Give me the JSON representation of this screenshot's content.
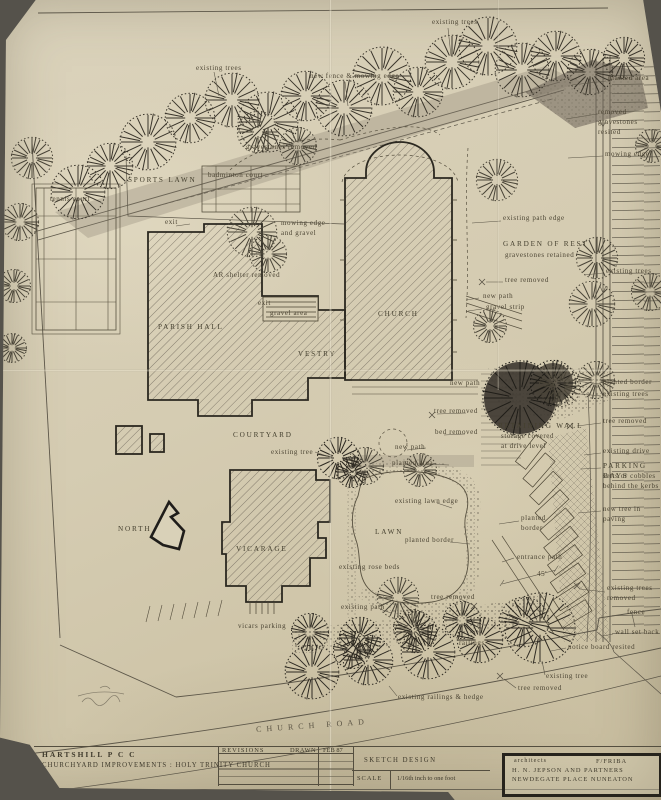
{
  "title_block": {
    "client": "HARTSHILL  P C C",
    "project": "CHURCHYARD IMPROVEMENTS : HOLY TRINITY CHURCH",
    "revisions_label": "REVISIONS",
    "drawn_label": "DRAWN",
    "drawn_date": "FEB 87",
    "stage": "SKETCH DESIGN",
    "scale_label": "SCALE",
    "scale_value": "1/16th inch to one foot"
  },
  "architects": {
    "label": "architects",
    "qualification": "F/FRIBA",
    "name": "H. N. JEPSON AND PARTNERS",
    "address": "NEWDEGATE PLACE NUNEATON"
  },
  "colors": {
    "paper": "#d5ccb2",
    "ink": "#4b4433",
    "building_outline": "#2b2820",
    "shading": "#6e675a"
  },
  "labels": [
    {
      "text": "existing trees",
      "x": 196,
      "y": 64,
      "cls": "tiny",
      "name": "label-existing-trees-top-left"
    },
    {
      "text": "new fence & mowing edge",
      "x": 310,
      "y": 72,
      "cls": "tiny",
      "name": "label-new-fence-mowing-edge"
    },
    {
      "text": "existing trees",
      "x": 432,
      "y": 18,
      "cls": "tiny",
      "name": "label-existing-trees-top"
    },
    {
      "text": "planted area",
      "x": 608,
      "y": 74,
      "cls": "tiny",
      "name": "label-planted-area-right"
    },
    {
      "text": "removed\ngravestones resited",
      "x": 598,
      "y": 108,
      "cls": "tiny",
      "name": "label-removed-gravestones-resited"
    },
    {
      "text": "mowing edge",
      "x": 605,
      "y": 150,
      "cls": "tiny",
      "name": "label-mowing-edge-right"
    },
    {
      "text": "existing trees",
      "x": 606,
      "y": 267,
      "cls": "tiny",
      "name": "label-existing-trees-right"
    },
    {
      "text": "gravestones removed",
      "x": 246,
      "y": 143,
      "cls": "tiny",
      "name": "label-gravestones-removed"
    },
    {
      "text": "SPORTS LAWN",
      "x": 128,
      "y": 175,
      "cls": "caps",
      "name": "label-sports-lawn"
    },
    {
      "text": "tennis court",
      "x": 50,
      "y": 195,
      "cls": "tiny",
      "name": "label-tennis-court"
    },
    {
      "text": "badminton court",
      "x": 208,
      "y": 171,
      "cls": "tiny",
      "name": "label-badminton-court"
    },
    {
      "text": "mowing edge\nand gravel",
      "x": 281,
      "y": 219,
      "cls": "tiny",
      "name": "label-mowing-edge-and-gravel"
    },
    {
      "text": "AR shelter removed",
      "x": 213,
      "y": 271,
      "cls": "tiny",
      "name": "label-ar-shelter-removed"
    },
    {
      "text": "exit",
      "x": 165,
      "y": 218,
      "cls": "tiny",
      "name": "label-exit-upper"
    },
    {
      "text": "exit",
      "x": 258,
      "y": 299,
      "cls": "tiny",
      "name": "label-exit-lower"
    },
    {
      "text": "gravel area",
      "x": 270,
      "y": 309,
      "cls": "tiny",
      "name": "label-gravel-area"
    },
    {
      "text": "existing path edge",
      "x": 503,
      "y": 214,
      "cls": "tiny",
      "name": "label-existing-path-edge"
    },
    {
      "text": "GARDEN OF REST",
      "x": 503,
      "y": 239,
      "cls": "caps",
      "name": "label-garden-of-rest"
    },
    {
      "text": "gravestones retained",
      "x": 505,
      "y": 251,
      "cls": "tiny",
      "name": "label-gravestones-retained"
    },
    {
      "text": "tree removed",
      "x": 505,
      "y": 276,
      "cls": "tiny",
      "name": "label-tree-removed-garden"
    },
    {
      "text": "new path",
      "x": 483,
      "y": 292,
      "cls": "tiny",
      "name": "label-new-path-garden"
    },
    {
      "text": "gravel strip",
      "x": 486,
      "y": 303,
      "cls": "tiny",
      "name": "label-gravel-strip"
    },
    {
      "text": "CHURCH",
      "x": 378,
      "y": 309,
      "cls": "caps",
      "name": "label-church"
    },
    {
      "text": "PARISH HALL",
      "x": 158,
      "y": 322,
      "cls": "caps",
      "name": "label-parish-hall"
    },
    {
      "text": "VESTRY",
      "x": 298,
      "y": 349,
      "cls": "caps",
      "name": "label-vestry"
    },
    {
      "text": "COURTYARD",
      "x": 233,
      "y": 430,
      "cls": "caps",
      "name": "label-courtyard"
    },
    {
      "text": "existing tree",
      "x": 271,
      "y": 448,
      "cls": "tiny",
      "name": "label-existing-tree-courtyard"
    },
    {
      "text": "new path",
      "x": 450,
      "y": 379,
      "cls": "tiny",
      "name": "label-new-path-terrace"
    },
    {
      "text": "tree removed",
      "x": 434,
      "y": 407,
      "cls": "tiny",
      "name": "label-tree-removed-terrace"
    },
    {
      "text": "bed removed",
      "x": 435,
      "y": 428,
      "cls": "tiny",
      "name": "label-bed-removed"
    },
    {
      "text": "new path",
      "x": 395,
      "y": 443,
      "cls": "tiny",
      "name": "label-new-path-courtyard"
    },
    {
      "text": "planted area",
      "x": 392,
      "y": 459,
      "cls": "tiny",
      "name": "label-planted-area-courtyard"
    },
    {
      "text": "planted border",
      "x": 603,
      "y": 378,
      "cls": "tiny",
      "name": "label-planted-border-right"
    },
    {
      "text": "existing trees",
      "x": 603,
      "y": 390,
      "cls": "tiny",
      "name": "label-existing-trees-bank"
    },
    {
      "text": "tree removed",
      "x": 603,
      "y": 417,
      "cls": "tiny",
      "name": "label-tree-removed-bank"
    },
    {
      "text": "RETAINING WALL",
      "x": 498,
      "y": 421,
      "cls": "caps",
      "name": "label-retaining-wall"
    },
    {
      "text": "storage covered\nat drive level",
      "x": 501,
      "y": 432,
      "cls": "tiny",
      "name": "label-storage-covered"
    },
    {
      "text": "existing drive",
      "x": 603,
      "y": 447,
      "cls": "tiny",
      "name": "label-existing-drive"
    },
    {
      "text": "PARKING BAYS",
      "x": 603,
      "y": 461,
      "cls": "caps",
      "name": "label-parking-bays"
    },
    {
      "text": "setts or cobbles\nbehind the kerbs",
      "x": 603,
      "y": 472,
      "cls": "tiny",
      "name": "label-setts-or-cobbles"
    },
    {
      "text": "new tree in paving",
      "x": 603,
      "y": 505,
      "cls": "tiny",
      "name": "label-new-tree-in-paving"
    },
    {
      "text": "planted\nborder",
      "x": 521,
      "y": 514,
      "cls": "tiny",
      "name": "label-planted-border-mid"
    },
    {
      "text": "existing lawn edge",
      "x": 395,
      "y": 497,
      "cls": "tiny",
      "name": "label-existing-lawn-edge"
    },
    {
      "text": "LAWN",
      "x": 375,
      "y": 527,
      "cls": "caps",
      "name": "label-lawn"
    },
    {
      "text": "planted border",
      "x": 405,
      "y": 536,
      "cls": "tiny",
      "name": "label-planted-border-lawn"
    },
    {
      "text": "VICARAGE",
      "x": 236,
      "y": 544,
      "cls": "caps",
      "name": "label-vicarage"
    },
    {
      "text": "existing rose beds",
      "x": 339,
      "y": 563,
      "cls": "tiny",
      "name": "label-existing-rose-beds"
    },
    {
      "text": "tree removed",
      "x": 431,
      "y": 593,
      "cls": "tiny",
      "name": "label-tree-removed-lawn"
    },
    {
      "text": "existing path",
      "x": 341,
      "y": 603,
      "cls": "tiny",
      "name": "label-existing-path"
    },
    {
      "text": "vicars parking",
      "x": 238,
      "y": 622,
      "cls": "tiny",
      "name": "label-vicars-parking"
    },
    {
      "text": "railings",
      "x": 459,
      "y": 639,
      "cls": "tiny",
      "name": "label-railings"
    },
    {
      "text": "entrance path",
      "x": 517,
      "y": 553,
      "cls": "tiny",
      "name": "label-entrance-path"
    },
    {
      "text": "45'",
      "x": 537,
      "y": 570,
      "cls": "tiny",
      "name": "label-dimension-45ft"
    },
    {
      "text": "existing trees\nremoved",
      "x": 607,
      "y": 584,
      "cls": "tiny",
      "name": "label-existing-trees-removed"
    },
    {
      "text": "fence",
      "x": 627,
      "y": 608,
      "cls": "tiny",
      "name": "label-fence"
    },
    {
      "text": "wall set back",
      "x": 615,
      "y": 628,
      "cls": "tiny",
      "name": "label-wall-set-back"
    },
    {
      "text": "notice board resited",
      "x": 568,
      "y": 643,
      "cls": "tiny",
      "name": "label-notice-board-resited"
    },
    {
      "text": "existing tree",
      "x": 546,
      "y": 672,
      "cls": "tiny",
      "name": "label-existing-tree-entrance"
    },
    {
      "text": "tree removed",
      "x": 518,
      "y": 684,
      "cls": "tiny",
      "name": "label-tree-removed-entrance"
    },
    {
      "text": "existing railings & hedge",
      "x": 398,
      "y": 693,
      "cls": "tiny",
      "name": "label-existing-railings-hedge"
    },
    {
      "text": "CHURCH   ROAD",
      "x": 256,
      "y": 720,
      "cls": "road",
      "name": "label-church-road"
    },
    {
      "text": "NORTH",
      "x": 118,
      "y": 524,
      "cls": "caps",
      "name": "label-north"
    }
  ]
}
